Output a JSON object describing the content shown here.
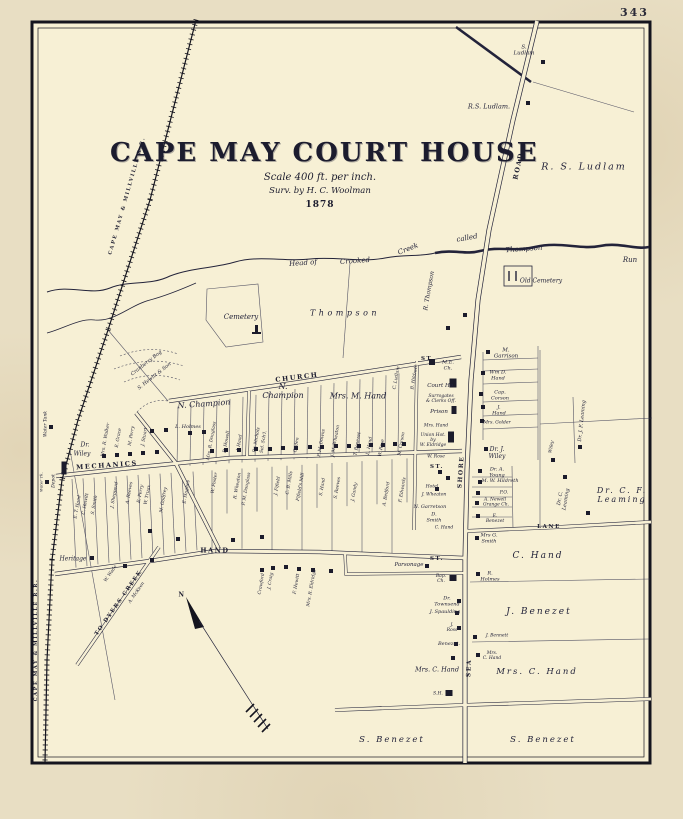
{
  "page_number": "343",
  "title": {
    "main": "CAPE MAY COURT HOUSE",
    "scale": "Scale 400 ft. per inch.",
    "surveyor": "Surv. by H. C. Woolman",
    "year": "1878"
  },
  "colors": {
    "paper": "#e8dec3",
    "sheet": "#f7f0d5",
    "ink": "#23233a"
  },
  "labels": [
    {
      "t": "S.\nLudlam",
      "x": 524,
      "y": 51,
      "s": 5.5
    },
    {
      "t": "R.S. Ludlam.",
      "x": 489,
      "y": 107,
      "s": 6.5
    },
    {
      "t": "R. S. Ludlam",
      "x": 584,
      "y": 168,
      "s": 9.5,
      "c": "big"
    },
    {
      "t": "ROAD",
      "x": 519,
      "y": 166,
      "r": -78,
      "s": 6.5,
      "c": "st"
    },
    {
      "t": "Head of",
      "x": 303,
      "y": 263,
      "r": -4,
      "s": 7
    },
    {
      "t": "Crooked",
      "x": 355,
      "y": 261,
      "r": -4,
      "s": 7
    },
    {
      "t": "Creek",
      "x": 408,
      "y": 249,
      "r": -22,
      "s": 7
    },
    {
      "t": "called",
      "x": 467,
      "y": 238,
      "r": -10,
      "s": 7
    },
    {
      "t": "Thompson",
      "x": 524,
      "y": 249,
      "r": -4,
      "s": 7
    },
    {
      "t": "Run",
      "x": 630,
      "y": 260,
      "s": 7
    },
    {
      "t": "Old Cemetery",
      "x": 541,
      "y": 282,
      "s": 6
    },
    {
      "t": "R. Thompson",
      "x": 430,
      "y": 291,
      "r": -80,
      "s": 6
    },
    {
      "t": "Cemetery",
      "x": 241,
      "y": 317,
      "s": 7
    },
    {
      "t": "Thompson",
      "x": 345,
      "y": 313,
      "s": 8,
      "c": "sp"
    },
    {
      "t": "M.\nGarrison",
      "x": 506,
      "y": 354,
      "s": 5.5
    },
    {
      "t": "ST.",
      "x": 428,
      "y": 359,
      "s": 5.5,
      "c": "st"
    },
    {
      "t": "CHURCH",
      "x": 297,
      "y": 378,
      "r": -7,
      "s": 6.5,
      "c": "st"
    },
    {
      "t": "M.E.\nCh.",
      "x": 448,
      "y": 366,
      "s": 5
    },
    {
      "t": "C. Ludlam",
      "x": 397,
      "y": 378,
      "r": -80,
      "s": 4.5
    },
    {
      "t": "B. Hildreth",
      "x": 415,
      "y": 377,
      "r": -80,
      "s": 4.5
    },
    {
      "t": "N. Champion",
      "x": 204,
      "y": 404,
      "r": -4,
      "s": 8
    },
    {
      "t": "N.\nChampion",
      "x": 283,
      "y": 391,
      "s": 8
    },
    {
      "t": "Mrs. M. Hand",
      "x": 358,
      "y": 396,
      "s": 8
    },
    {
      "t": "Cranberry Bog",
      "x": 147,
      "y": 364,
      "r": -38,
      "s": 5
    },
    {
      "t": "S. Hewitt & Son",
      "x": 155,
      "y": 377,
      "r": -38,
      "s": 5
    },
    {
      "t": "Wm D.\nHand",
      "x": 498,
      "y": 376,
      "s": 5
    },
    {
      "t": "Cap.\nCorson",
      "x": 500,
      "y": 396,
      "s": 5
    },
    {
      "t": "J.\nHand",
      "x": 499,
      "y": 411,
      "s": 5
    },
    {
      "t": "Mrs. Golder",
      "x": 497,
      "y": 423,
      "s": 4.5
    },
    {
      "t": "Court Ho.",
      "x": 441,
      "y": 386,
      "s": 5.5
    },
    {
      "t": "Surrogates\n& Clerks Off.",
      "x": 441,
      "y": 399,
      "s": 4.5
    },
    {
      "t": "Prison",
      "x": 439,
      "y": 412,
      "s": 5.5
    },
    {
      "t": "Mrs. Hand",
      "x": 436,
      "y": 426,
      "s": 4.5
    },
    {
      "t": "Union Hot.\nby\nW. Eldridge",
      "x": 433,
      "y": 441,
      "s": 4.5
    },
    {
      "t": "W. Rose",
      "x": 436,
      "y": 457,
      "s": 4.5
    },
    {
      "t": "ST.",
      "x": 437,
      "y": 467,
      "s": 5.5,
      "c": "st"
    },
    {
      "t": "SHORE",
      "x": 462,
      "y": 472,
      "r": -86,
      "s": 6,
      "c": "st"
    },
    {
      "t": "Dr. J.\nWiley",
      "x": 497,
      "y": 454,
      "s": 6
    },
    {
      "t": "Wiley",
      "x": 552,
      "y": 447,
      "r": -80,
      "s": 4.5
    },
    {
      "t": "Dr. J. F. Leaming",
      "x": 583,
      "y": 421,
      "r": -84,
      "s": 5
    },
    {
      "t": "Dr. C.\nLeaming",
      "x": 564,
      "y": 499,
      "r": -80,
      "s": 5
    },
    {
      "t": "Dr. C. F.\nLeaming",
      "x": 622,
      "y": 495,
      "s": 8,
      "c": "big"
    },
    {
      "t": "LANE",
      "x": 549,
      "y": 527,
      "s": 5.5,
      "c": "st"
    },
    {
      "t": "L. Holmes",
      "x": 188,
      "y": 428,
      "s": 5
    },
    {
      "t": "MECHANICS",
      "x": 107,
      "y": 466,
      "r": -4,
      "s": 6.5,
      "c": "st"
    },
    {
      "t": "Dr.",
      "x": 85,
      "y": 446,
      "s": 6
    },
    {
      "t": "Wiley",
      "x": 82,
      "y": 455,
      "s": 6
    },
    {
      "t": "Heritage",
      "x": 73,
      "y": 560,
      "s": 6
    },
    {
      "t": "HAND",
      "x": 215,
      "y": 551,
      "s": 6.5,
      "c": "st"
    },
    {
      "t": "ST.",
      "x": 437,
      "y": 559,
      "s": 5.5,
      "c": "st"
    },
    {
      "t": "Parsonage",
      "x": 409,
      "y": 565,
      "s": 5.5
    },
    {
      "t": "Bap.\nCh.",
      "x": 441,
      "y": 579,
      "s": 4.5
    },
    {
      "t": "Dr.\nTownsend",
      "x": 447,
      "y": 602,
      "s": 5
    },
    {
      "t": "J. Spaulding",
      "x": 445,
      "y": 613,
      "s": 5
    },
    {
      "t": "J.\nRoss",
      "x": 452,
      "y": 628,
      "s": 4.5
    },
    {
      "t": "Benezet.",
      "x": 449,
      "y": 645,
      "s": 5
    },
    {
      "t": "Mrs. C. Hand",
      "x": 437,
      "y": 670,
      "s": 6.5
    },
    {
      "t": "SEA",
      "x": 470,
      "y": 668,
      "r": -88,
      "s": 6,
      "c": "st"
    },
    {
      "t": "Mrs G.\nSmith",
      "x": 489,
      "y": 539,
      "s": 5
    },
    {
      "t": "C. Hand",
      "x": 538,
      "y": 556,
      "s": 9,
      "c": "big"
    },
    {
      "t": "R.\nHolmes",
      "x": 490,
      "y": 577,
      "s": 5
    },
    {
      "t": "J. Benezet",
      "x": 539,
      "y": 612,
      "s": 9,
      "c": "big"
    },
    {
      "t": "J. Bennett",
      "x": 497,
      "y": 636,
      "s": 4.5
    },
    {
      "t": "Mrs.\nC. Hand",
      "x": 492,
      "y": 656,
      "s": 4.5
    },
    {
      "t": "Mrs. C. Hand",
      "x": 537,
      "y": 673,
      "s": 8.5,
      "c": "big"
    },
    {
      "t": "S. Benezet",
      "x": 392,
      "y": 741,
      "s": 8.5,
      "c": "big"
    },
    {
      "t": "S. Benezet",
      "x": 543,
      "y": 741,
      "s": 8.5,
      "c": "big"
    },
    {
      "t": "S.H.",
      "x": 438,
      "y": 694,
      "s": 4.5
    },
    {
      "t": "TO DYERS CREEK",
      "x": 119,
      "y": 603,
      "r": -55,
      "s": 5.5,
      "c": "st"
    },
    {
      "t": "W. Wade",
      "x": 111,
      "y": 574,
      "r": -55,
      "s": 4.5
    },
    {
      "t": "A. McKeen",
      "x": 137,
      "y": 593,
      "r": -55,
      "s": 4.5
    },
    {
      "t": "N",
      "x": 182,
      "y": 596,
      "s": 6,
      "c": "st"
    },
    {
      "t": "CAPE MAY & MILLVILLE R.R.",
      "x": 128,
      "y": 196,
      "r": -74,
      "s": 5,
      "c": "st"
    },
    {
      "t": "CAPE MAY & MILLVILLE R.R.",
      "x": 37,
      "y": 640,
      "r": -90,
      "s": 5,
      "c": "st"
    },
    {
      "t": "Water Tank",
      "x": 46,
      "y": 424,
      "r": -90,
      "s": 4.5
    },
    {
      "t": "Water Tk.",
      "x": 42,
      "y": 482,
      "r": -90,
      "s": 4
    },
    {
      "t": "Depot",
      "x": 54,
      "y": 481,
      "r": -90,
      "s": 4.5
    },
    {
      "t": "Mrs. R. Walker",
      "x": 106,
      "y": 440,
      "r": -80,
      "s": 4.5
    },
    {
      "t": "E. Grace",
      "x": 119,
      "y": 438,
      "r": -80,
      "s": 4.5
    },
    {
      "t": "M. Perry",
      "x": 132,
      "y": 436,
      "r": -80,
      "s": 4.5
    },
    {
      "t": "J. Stuart",
      "x": 145,
      "y": 437,
      "r": -80,
      "s": 4.5
    },
    {
      "t": "Mrs. R. Douglass",
      "x": 212,
      "y": 441,
      "r": -80,
      "s": 4.5
    },
    {
      "t": "R. Howell",
      "x": 227,
      "y": 442,
      "r": -80,
      "s": 4.5
    },
    {
      "t": "J. Hand",
      "x": 240,
      "y": 443,
      "r": -80,
      "s": 4.5
    },
    {
      "t": "Dr. Nichols",
      "x": 257,
      "y": 440,
      "r": -80,
      "s": 4.5
    },
    {
      "t": "Sel. Sch'l.",
      "x": 264,
      "y": 442,
      "r": -80,
      "s": 4.5
    },
    {
      "t": "Ogden",
      "x": 297,
      "y": 445,
      "r": -80,
      "s": 4.5
    },
    {
      "t": "P. M. Downs",
      "x": 322,
      "y": 443,
      "r": -80,
      "s": 4.5
    },
    {
      "t": "J. M. Wheaton",
      "x": 336,
      "y": 441,
      "r": -80,
      "s": 4.5
    },
    {
      "t": "T. Benezet",
      "x": 358,
      "y": 444,
      "r": -80,
      "s": 4.5
    },
    {
      "t": "L. Hand",
      "x": 370,
      "y": 446,
      "r": -80,
      "s": 4.5
    },
    {
      "t": "W. Rose",
      "x": 382,
      "y": 448,
      "r": -80,
      "s": 4.5
    },
    {
      "t": "M. Corson",
      "x": 402,
      "y": 444,
      "r": -80,
      "s": 4.5
    },
    {
      "t": "E. T. Hand",
      "x": 78,
      "y": 507,
      "r": -80,
      "s": 4.5
    },
    {
      "t": "C. Hewitt",
      "x": 86,
      "y": 504,
      "r": -80,
      "s": 4.5
    },
    {
      "t": "S. Smith",
      "x": 95,
      "y": 505,
      "r": -80,
      "s": 4.5
    },
    {
      "t": "J. Shepperd",
      "x": 115,
      "y": 495,
      "r": -80,
      "s": 4.5
    },
    {
      "t": "A. Reeves",
      "x": 130,
      "y": 493,
      "r": -80,
      "s": 4.5
    },
    {
      "t": "E. Perry",
      "x": 141,
      "y": 494,
      "r": -80,
      "s": 4.5
    },
    {
      "t": "W. Truax",
      "x": 148,
      "y": 495,
      "r": -80,
      "s": 4.5
    },
    {
      "t": "M. Godfrey",
      "x": 164,
      "y": 500,
      "r": -80,
      "s": 4.5
    },
    {
      "t": "E. Hughes",
      "x": 187,
      "y": 492,
      "r": -80,
      "s": 4.5
    },
    {
      "t": "W. Foster",
      "x": 215,
      "y": 483,
      "r": -80,
      "s": 4.5
    },
    {
      "t": "R. Wheaton",
      "x": 238,
      "y": 486,
      "r": -80,
      "s": 4.5
    },
    {
      "t": "P. M. Douglass",
      "x": 247,
      "y": 489,
      "r": -80,
      "s": 4.5
    },
    {
      "t": "J. Fifield",
      "x": 278,
      "y": 486,
      "r": -80,
      "s": 4.5
    },
    {
      "t": "C. B. Mills",
      "x": 290,
      "y": 483,
      "r": -80,
      "s": 4.5
    },
    {
      "t": "Fifield's Mill",
      "x": 301,
      "y": 487,
      "r": -80,
      "s": 4.5
    },
    {
      "t": "S. Hand",
      "x": 323,
      "y": 487,
      "r": -80,
      "s": 4.5
    },
    {
      "t": "S. Reeves",
      "x": 338,
      "y": 488,
      "r": -80,
      "s": 4.5
    },
    {
      "t": "J. Gandy",
      "x": 355,
      "y": 492,
      "r": -80,
      "s": 4.5
    },
    {
      "t": "A. Bedford",
      "x": 387,
      "y": 494,
      "r": -80,
      "s": 4.5
    },
    {
      "t": "F. Edwards",
      "x": 403,
      "y": 490,
      "r": -80,
      "s": 4.5
    },
    {
      "t": "Hotel",
      "x": 432,
      "y": 487,
      "s": 4.5
    },
    {
      "t": "J. Wheaton",
      "x": 434,
      "y": 495,
      "s": 4.5
    },
    {
      "t": "N. Garretson",
      "x": 430,
      "y": 508,
      "s": 5
    },
    {
      "t": "D.\nSmith",
      "x": 434,
      "y": 518,
      "s": 5
    },
    {
      "t": "C. Hand",
      "x": 444,
      "y": 528,
      "s": 4.5
    },
    {
      "t": "Crawford",
      "x": 262,
      "y": 584,
      "r": -80,
      "s": 4.5
    },
    {
      "t": "J. Craig",
      "x": 271,
      "y": 581,
      "r": -80,
      "s": 4.5
    },
    {
      "t": "F. Hewitt",
      "x": 297,
      "y": 584,
      "r": -80,
      "s": 4.5
    },
    {
      "t": "Mrs. R. Eldridge",
      "x": 312,
      "y": 588,
      "r": -80,
      "s": 4.5
    },
    {
      "t": "Dr. A.\nYoung",
      "x": 497,
      "y": 473,
      "s": 5
    },
    {
      "t": "M. W. Hildreth",
      "x": 500,
      "y": 482,
      "s": 5
    },
    {
      "t": "P.O.",
      "x": 504,
      "y": 493,
      "s": 4.5
    },
    {
      "t": "A. Newell",
      "x": 495,
      "y": 500,
      "s": 4.5
    },
    {
      "t": "Grange Ch.",
      "x": 496,
      "y": 505,
      "s": 4.5
    },
    {
      "t": "E.\nBenezet",
      "x": 495,
      "y": 519,
      "s": 4.5
    }
  ]
}
